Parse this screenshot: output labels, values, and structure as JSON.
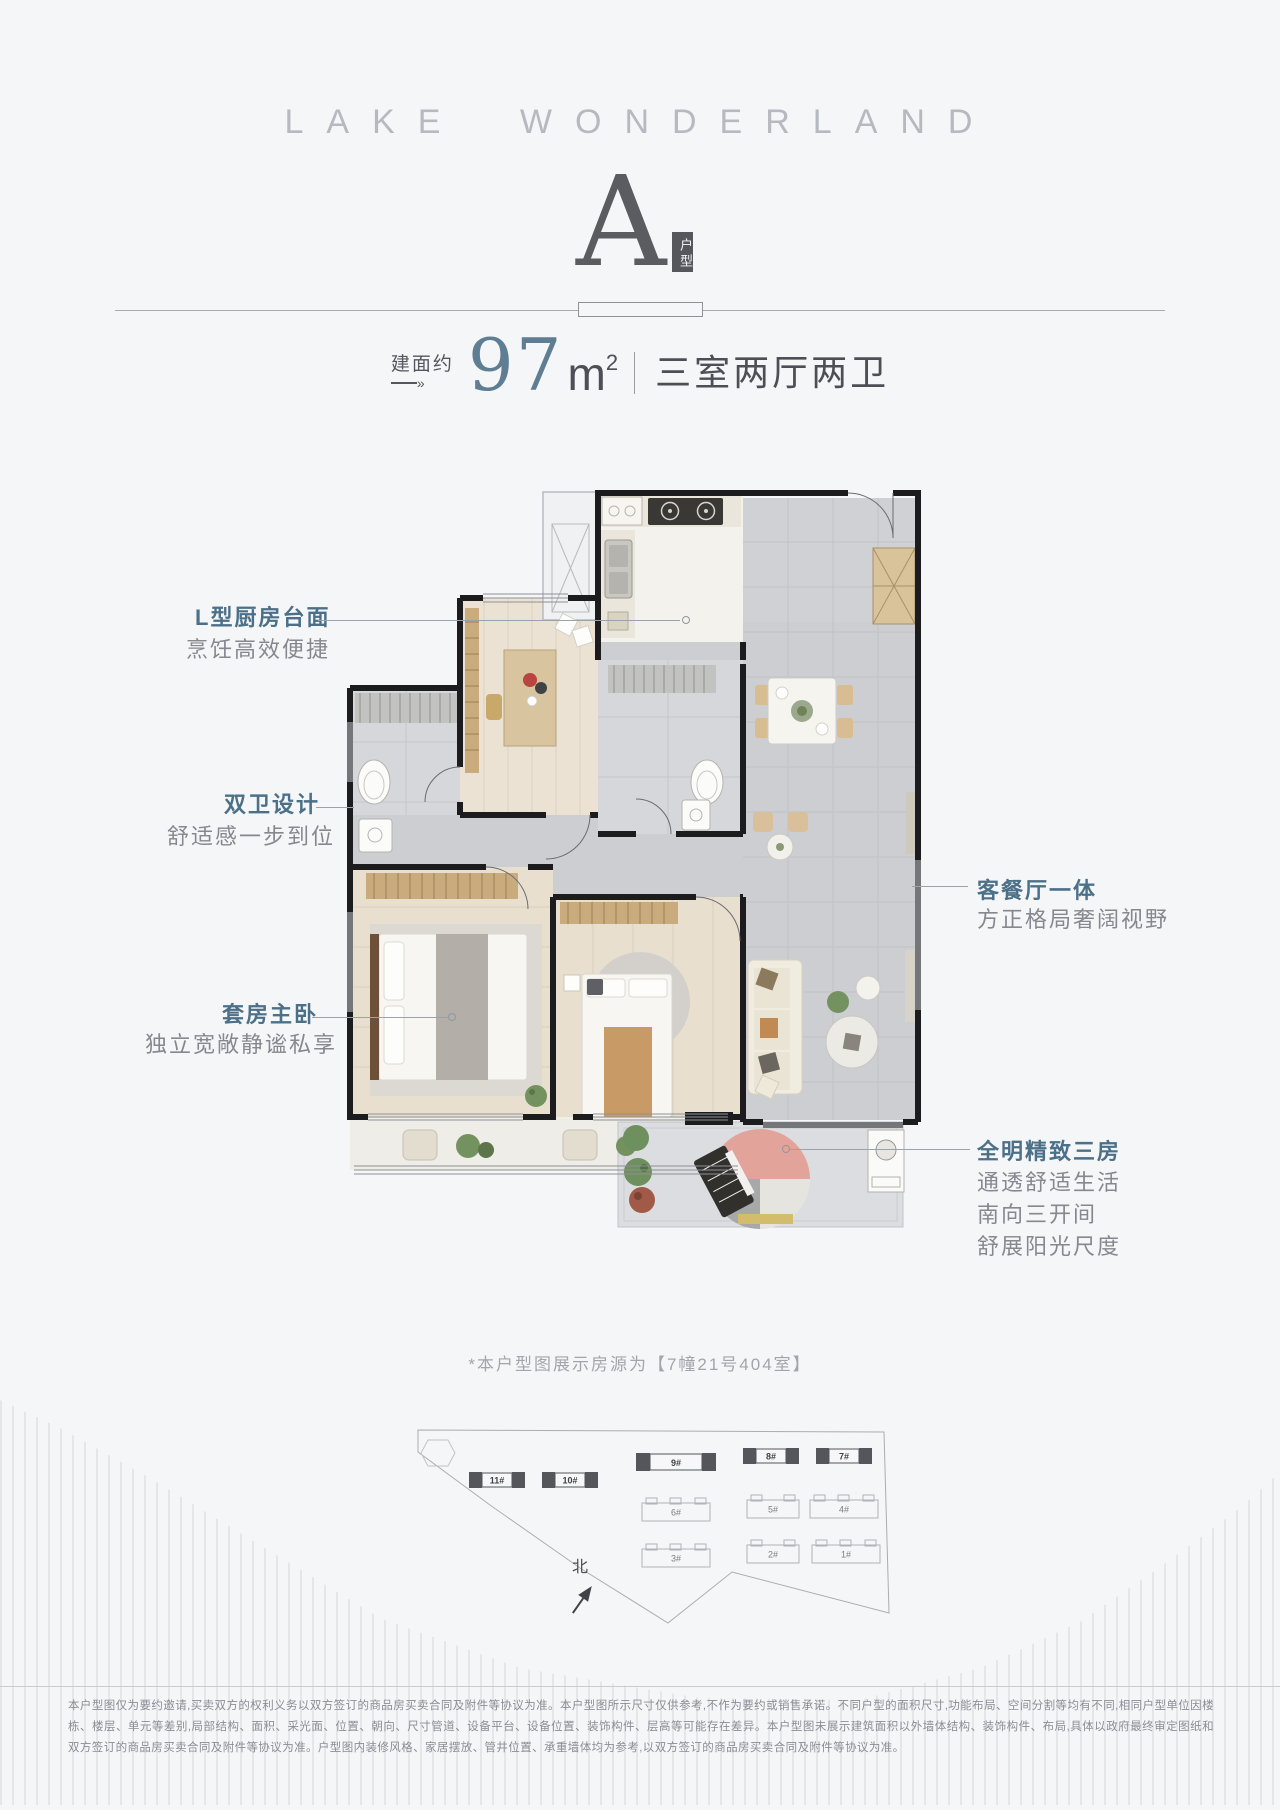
{
  "header": {
    "title": "LAKE WONDERLAND"
  },
  "unit": {
    "letter": "A",
    "badge": "户型"
  },
  "area": {
    "prefix": "建面约",
    "arrow_tip": "»",
    "value": "97",
    "unit": "m",
    "sup": "2",
    "rooms": "三室两厅两卫"
  },
  "accent_color": "#4c7088",
  "callouts": [
    {
      "id": "kitchen",
      "title": "L型厨房台面",
      "descs": [
        "烹饪高效便捷"
      ]
    },
    {
      "id": "baths",
      "title": "双卫设计",
      "descs": [
        "舒适感一步到位"
      ]
    },
    {
      "id": "master",
      "title": "套房主卧",
      "descs": [
        "独立宽敞静谧私享"
      ]
    },
    {
      "id": "living",
      "title": "客餐厅一体",
      "descs": [
        "方正格局奢阔视野"
      ]
    },
    {
      "id": "rooms",
      "title": "全明精致三房",
      "descs": [
        "通透舒适生活",
        "南向三开间",
        "舒展阳光尺度"
      ]
    }
  ],
  "footnote": "*本户型图展示房源为【7幢21号404室】",
  "site": {
    "north": "北",
    "buildings": [
      {
        "label": "11#",
        "style": "dark"
      },
      {
        "label": "10#",
        "style": "dark"
      },
      {
        "label": "9#",
        "style": "dark"
      },
      {
        "label": "8#",
        "style": "dark"
      },
      {
        "label": "7#",
        "style": "dark"
      },
      {
        "label": "6#",
        "style": "outline"
      },
      {
        "label": "5#",
        "style": "outline"
      },
      {
        "label": "4#",
        "style": "outline"
      },
      {
        "label": "3#",
        "style": "outline"
      },
      {
        "label": "2#",
        "style": "outline"
      },
      {
        "label": "1#",
        "style": "outline"
      }
    ]
  },
  "disclaimer": "本户型图仅为要约邀请,买卖双方的权利义务以双方签订的商品房买卖合同及附件等协议为准。本户型图所示尺寸仅供参考,不作为要约或销售承诺。不同户型的面积尺寸,功能布局、空间分割等均有不同,相同户型单位因楼栋、楼层、单元等差别,局部结构、面积、采光面、位置、朝向、尺寸管道、设备平台、设备位置、装饰构件、层高等可能存在差异。本户型图未展示建筑面积以外墙体结构、装饰构件、布局,具体以政府最终审定图纸和双方签订的商品房买卖合同及附件等协议为准。户型图内装修风格、家居摆放、管井位置、承重墙体均为参考,以双方签订的商品房买卖合同及附件等协议为准。"
}
